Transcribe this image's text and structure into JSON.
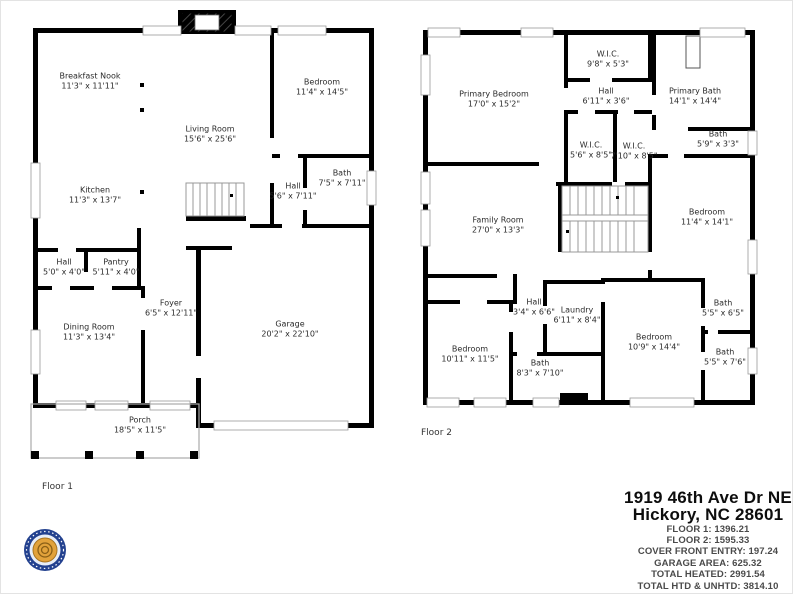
{
  "floor1": {
    "label": "Floor 1",
    "rooms": [
      {
        "name": "Breakfast Nook",
        "dims": "11'3\" x 11'11\""
      },
      {
        "name": "Living Room",
        "dims": "15'6\" x 25'6\""
      },
      {
        "name": "Bedroom",
        "dims": "11'4\" x 14'5\""
      },
      {
        "name": "Kitchen",
        "dims": "11'3\" x 13'7\""
      },
      {
        "name": "Bath",
        "dims": "7'5\" x 7'11\""
      },
      {
        "name": "Hall",
        "dims": "5'6\" x 7'11\""
      },
      {
        "name": "Hall",
        "dims": "5'0\" x 4'0\""
      },
      {
        "name": "Pantry",
        "dims": "5'11\" x 4'0\""
      },
      {
        "name": "Foyer",
        "dims": "6'5\" x 12'11\""
      },
      {
        "name": "Dining Room",
        "dims": "11'3\" x 13'4\""
      },
      {
        "name": "Garage",
        "dims": "20'2\" x 22'10\""
      },
      {
        "name": "Porch",
        "dims": "18'5\" x 11'5\""
      }
    ]
  },
  "floor2": {
    "label": "Floor 2",
    "rooms": [
      {
        "name": "Primary Bedroom",
        "dims": "17'0\" x 15'2\""
      },
      {
        "name": "W.I.C.",
        "dims": "9'8\" x 5'3\""
      },
      {
        "name": "Hall",
        "dims": "6'11\" x 3'6\""
      },
      {
        "name": "Primary Bath",
        "dims": "14'1\" x 14'4\""
      },
      {
        "name": "W.I.C.",
        "dims": "5'6\" x 8'5\""
      },
      {
        "name": "W.I.C.",
        "dims": "7'10\" x 8'5\""
      },
      {
        "name": "Bath",
        "dims": "5'9\" x 3'3\""
      },
      {
        "name": "Family Room",
        "dims": "27'0\" x 13'3\""
      },
      {
        "name": "Bedroom",
        "dims": "11'4\" x 14'1\""
      },
      {
        "name": "Hall",
        "dims": "3'4\" x 6'6\""
      },
      {
        "name": "Laundry",
        "dims": "6'11\" x 8'4\""
      },
      {
        "name": "Bedroom",
        "dims": "10'11\" x 11'5\""
      },
      {
        "name": "Bath",
        "dims": "8'3\" x 7'10\""
      },
      {
        "name": "Bedroom",
        "dims": "10'9\" x 14'4\""
      },
      {
        "name": "Bath",
        "dims": "5'5\" x 6'5\""
      },
      {
        "name": "Bath",
        "dims": "5'5\" x 7'6\""
      }
    ]
  },
  "summary": {
    "address_line1": "1919 46th Ave Dr NE",
    "address_line2": "Hickory, NC 28601",
    "lines": [
      "FLOOR 1: 1396.21",
      "FLOOR 2: 1595.33",
      "COVER FRONT ENTRY: 197.24",
      "GARAGE AREA: 625.32",
      "TOTAL HEATED: 2991.54",
      "TOTAL HTD & UNHTD: 3814.10"
    ]
  },
  "logo": {
    "icon": "circular-company-badge",
    "ring_color": "#23418f",
    "center_color": "#e2a23b"
  },
  "colors": {
    "walls": "#000000",
    "window_stroke": "#999999",
    "background": "#ffffff"
  }
}
